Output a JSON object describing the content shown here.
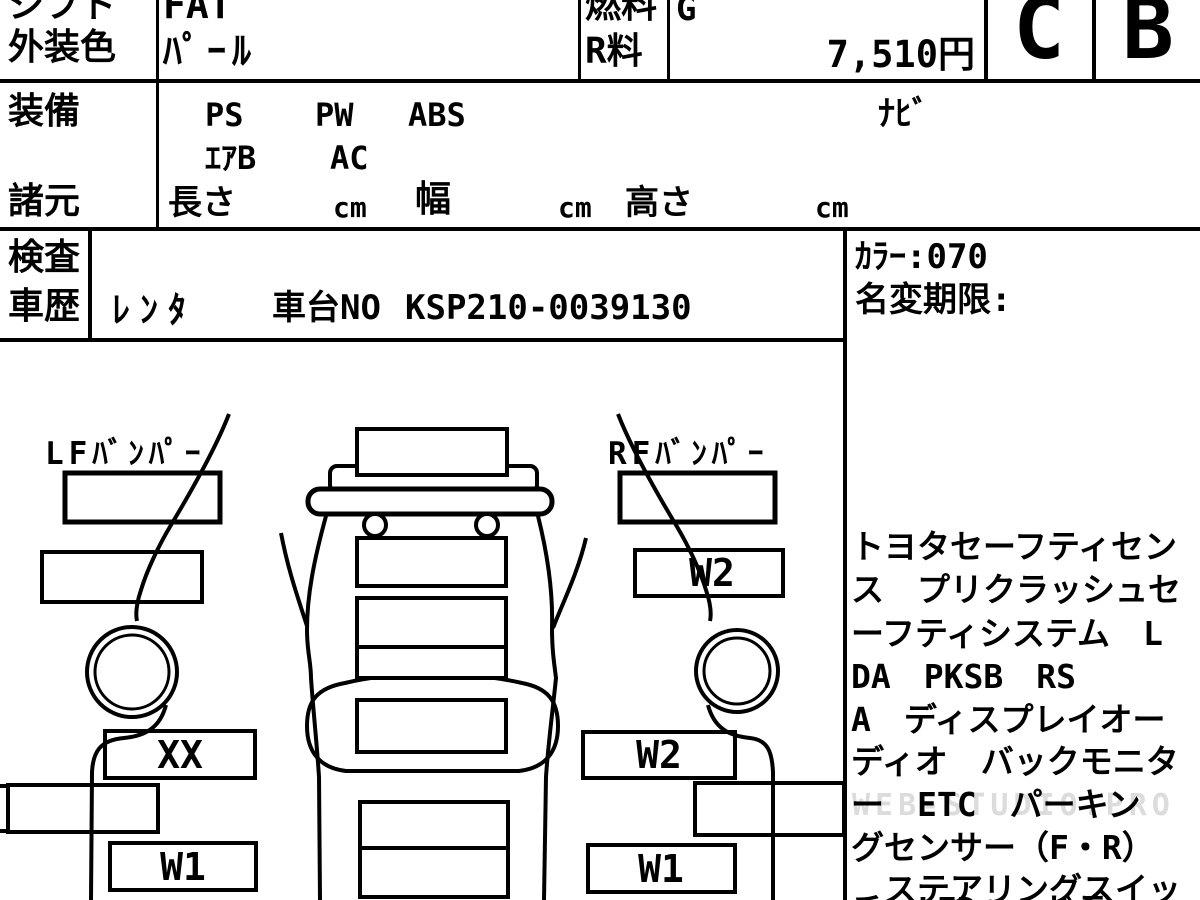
{
  "header": {
    "shift_label": "シフト",
    "shift_value": "FAT",
    "ext_color_label": "外装色",
    "ext_color_value": "ﾊﾟｰﾙ",
    "fuel_label": "燃料",
    "fuel_value": "G",
    "r_fee_label": "R料",
    "r_fee_value": "7,510円",
    "grade_exterior": "C",
    "grade_interior": "B",
    "equipment_label": "装備",
    "equipment_row1": [
      "PS",
      "PW",
      "ABS"
    ],
    "equipment_row2": [
      "ｴｱB",
      "AC"
    ],
    "navi": "ﾅﾋﾞ",
    "specs_label": "諸元",
    "length_label": "長さ",
    "width_label": "幅",
    "height_label": "高さ",
    "unit_cm": "cm",
    "inspection_label": "検査",
    "history_label": "車歴",
    "history_value": "ﾚﾝﾀ",
    "chassis_label": "車台NO",
    "chassis_value": "KSP210-0039130",
    "color_code": "ｶﾗｰ:070",
    "rename_deadline": "名変期限:"
  },
  "diagram": {
    "lf_bumper_label": "LFﾊﾞﾝﾊﾟｰ",
    "rf_bumper_label": "RFﾊﾞﾝﾊﾟｰ",
    "mark_left_door": "XX",
    "mark_left_rear": "W1",
    "mark_right_fender": "W2",
    "mark_right_door": "W2",
    "mark_right_rear": "W1"
  },
  "equipment_notes": {
    "lines": [
      "トヨタセーフティセン",
      "ス　プリクラッシュセ",
      "ーフティシステム　L",
      "DA　PKSB　RS",
      "A　ディスプレイオー",
      "ディオ　バックモニタ",
      "ー　ETC　パーキン",
      "グセンサー（F・R）",
      "　ステアリングスイッ",
      "チ　LEDヘッドラ"
    ]
  },
  "watermark": "WEB-STUDIO.PRO"
}
